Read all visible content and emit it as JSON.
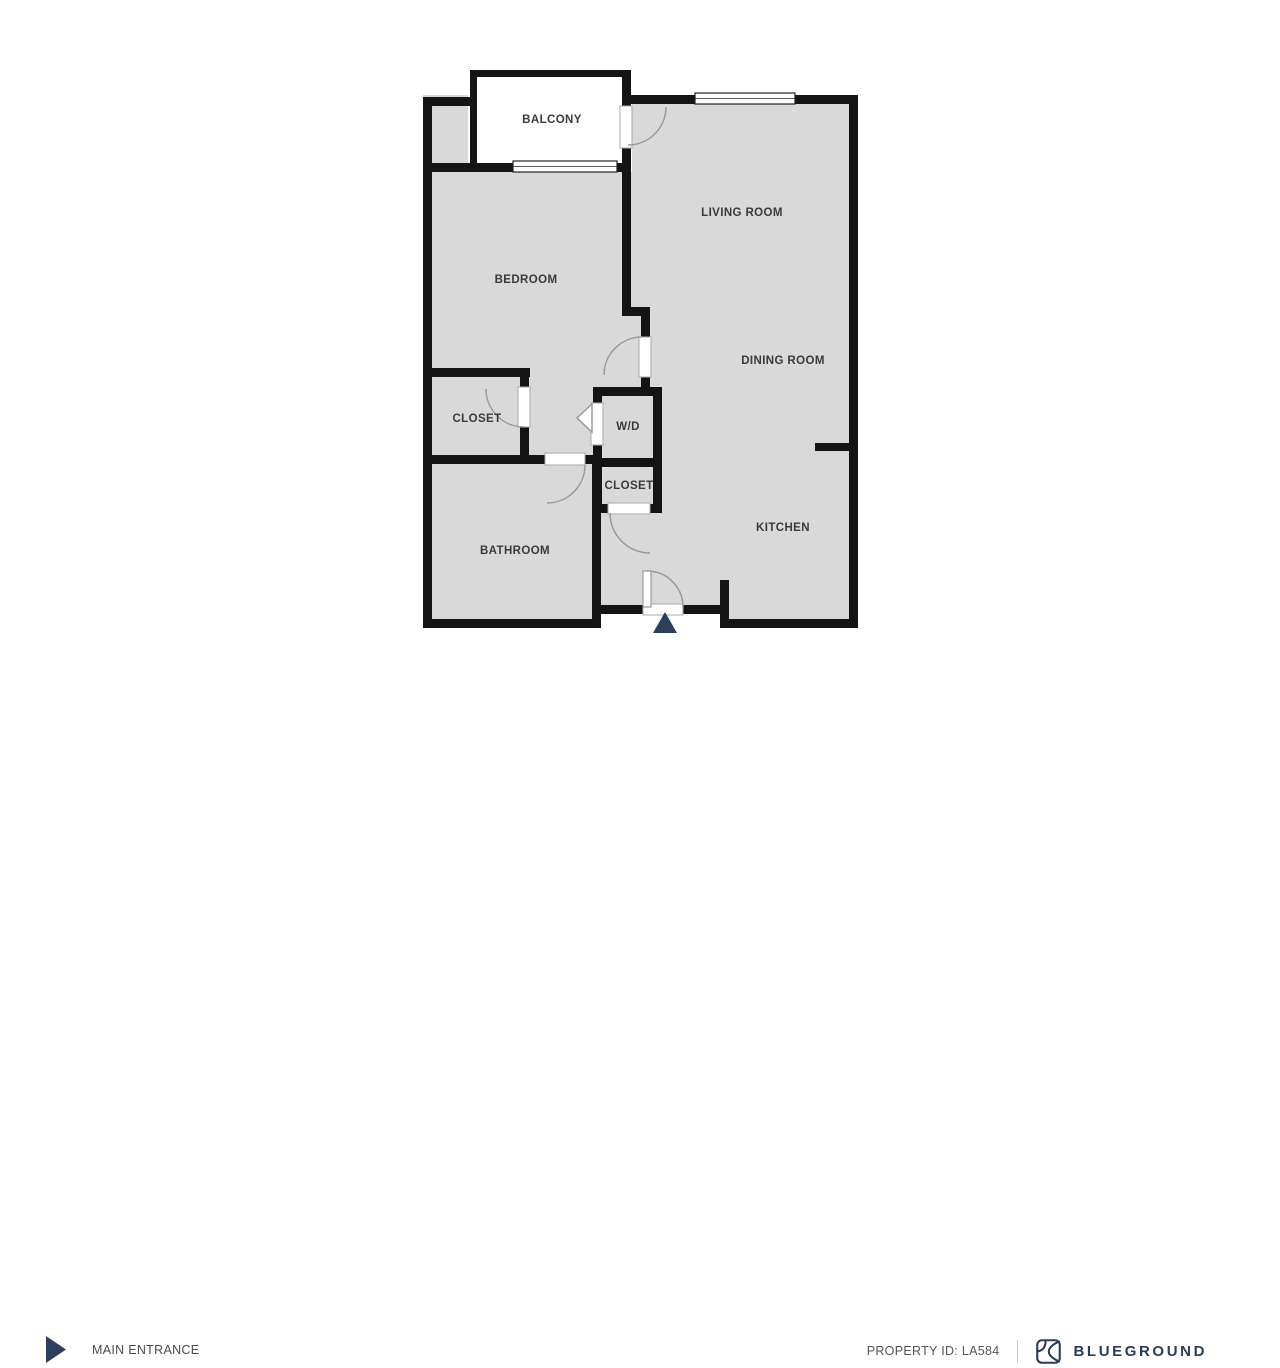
{
  "floorplan": {
    "rooms": {
      "balcony": "BALCONY",
      "living_room": "LIVING ROOM",
      "bedroom": "BEDROOM",
      "dining_room": "DINING ROOM",
      "closet_left": "CLOSET",
      "wd": "W/D",
      "closet_center": "CLOSET",
      "bathroom": "BATHROOM",
      "kitchen": "KITCHEN"
    },
    "colors": {
      "floor": "#d9d9d9",
      "wall": "#141414",
      "door_arc": "#9a9a9a",
      "entrance_marker": "#2d3e5e"
    }
  },
  "footer": {
    "main_entrance_label": "MAIN ENTRANCE",
    "property_id_label": "PROPERTY ID: LA584",
    "brand_name": "BLUEGROUND",
    "brand_color": "#2b3c5a",
    "text_color": "#4b4b4b"
  }
}
